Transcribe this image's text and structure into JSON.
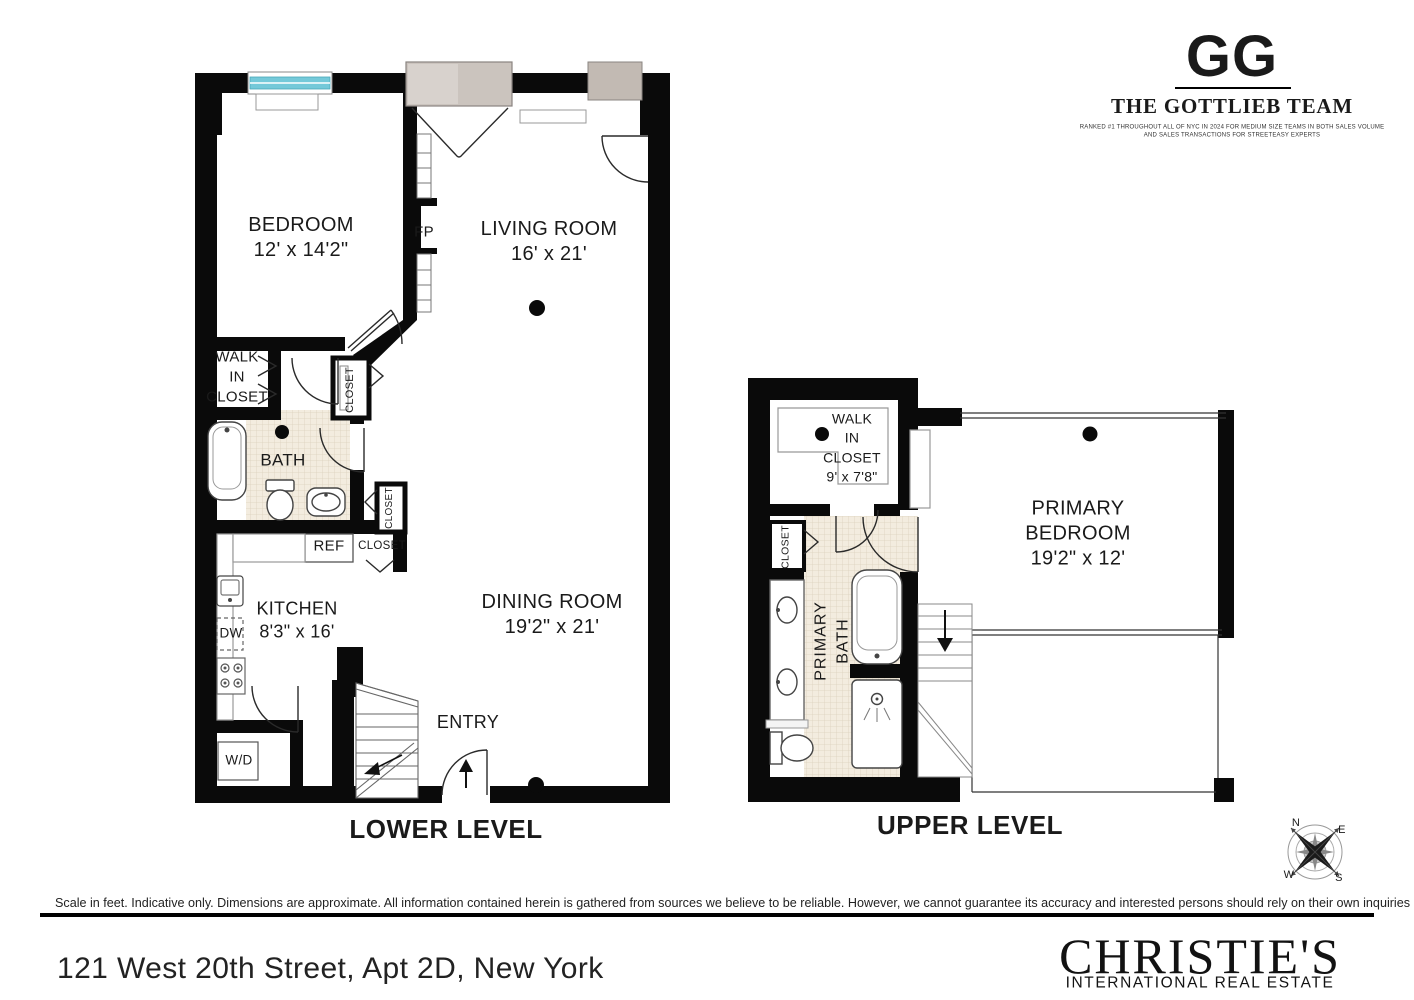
{
  "branding": {
    "gg_logo": "GG",
    "team_name": "THE GOTTLIEB TEAM",
    "tagline_line1": "RANKED #1 THROUGHOUT ALL OF NYC IN 2024 FOR MEDIUM SIZE TEAMS IN BOTH SALES VOLUME",
    "tagline_line2": "AND SALES TRANSACTIONS FOR STREETEASY EXPERTS",
    "brokerage_name": "CHRISTIE'S",
    "brokerage_subtitle": "INTERNATIONAL REAL ESTATE"
  },
  "footer": {
    "disclaimer": "Scale in feet. Indicative only. Dimensions are approximate. All information contained herein is gathered from sources we believe to be reliable. However, we cannot guarantee its accuracy and interested persons should rely on their own inquiries .",
    "address": "121 West 20th Street, Apt 2D, New York"
  },
  "lower": {
    "title": "LOWER LEVEL",
    "rooms": {
      "bedroom": {
        "name": "BEDROOM",
        "dims": "12' x 14'2\""
      },
      "living": {
        "name": "LIVING ROOM",
        "dims": "16' x 21'"
      },
      "dining": {
        "name": "DINING ROOM",
        "dims": "19'2\" x 21'"
      },
      "kitchen": {
        "name": "KITCHEN",
        "dims": "8'3\" x 16'"
      },
      "bath": {
        "name": "BATH"
      },
      "wic": {
        "l1": "WALK",
        "l2": "IN",
        "l3": "CLOSET"
      },
      "entry": {
        "name": "ENTRY"
      }
    },
    "labels": {
      "fp": "FP",
      "ref": "REF",
      "dw": "DW",
      "wd": "W/D",
      "closet": "CLOSET"
    }
  },
  "upper": {
    "title": "UPPER LEVEL",
    "rooms": {
      "wic": {
        "l1": "WALK",
        "l2": "IN",
        "l3": "CLOSET",
        "dims": "9' x 7'8\""
      },
      "pbath": {
        "l1": "PRIMARY",
        "l2": "BATH"
      },
      "pbed": {
        "l1": "PRIMARY",
        "l2": "BEDROOM",
        "dims": "19'2\" x 12'"
      },
      "closet": "CLOSET"
    }
  },
  "compass": {
    "n": "N",
    "e": "E",
    "w": "W",
    "s": "S"
  },
  "colors": {
    "wall": "#0a0a0a",
    "tile": "#f3ecdf",
    "window_glass": "#74c9d9",
    "window_gray": "#cbc4be",
    "text": "#1a1a1a"
  }
}
